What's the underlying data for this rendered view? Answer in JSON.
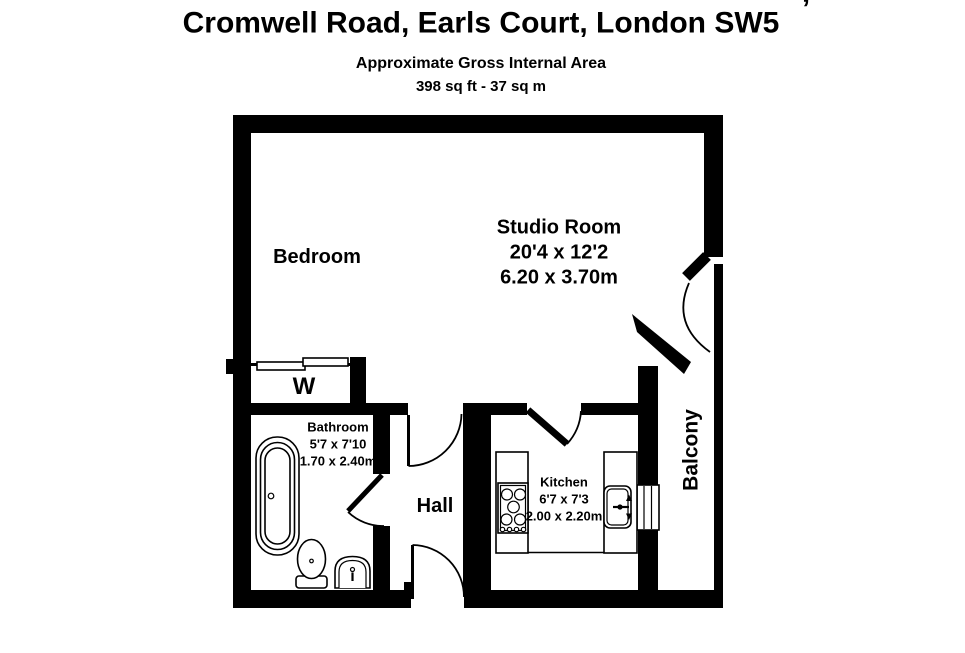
{
  "page": {
    "background": "#ffffff",
    "ink": "#000000"
  },
  "header": {
    "cropped_line_fragment": "’",
    "title": "Cromwell Road, Earls Court, London SW5",
    "area_line1": "Approximate Gross Internal Area",
    "area_line2": "398 sq ft - 37 sq m"
  },
  "floorplan": {
    "studio_room": {
      "name": "Studio Room",
      "size_imperial": "20'4 x 12'2",
      "size_metric": "6.20 x 3.70m"
    },
    "bedroom": {
      "name": "Bedroom"
    },
    "wardrobe": {
      "name": "W"
    },
    "bathroom": {
      "name": "Bathroom",
      "size_imperial": "5'7 x 7'10",
      "size_metric": "1.70 x 2.40m"
    },
    "hall": {
      "name": "Hall"
    },
    "kitchen": {
      "name": "Kitchen",
      "size_imperial": "6'7 x 7'3",
      "size_metric": "2.00 x 2.20m"
    },
    "balcony": {
      "name": "Balcony"
    }
  }
}
